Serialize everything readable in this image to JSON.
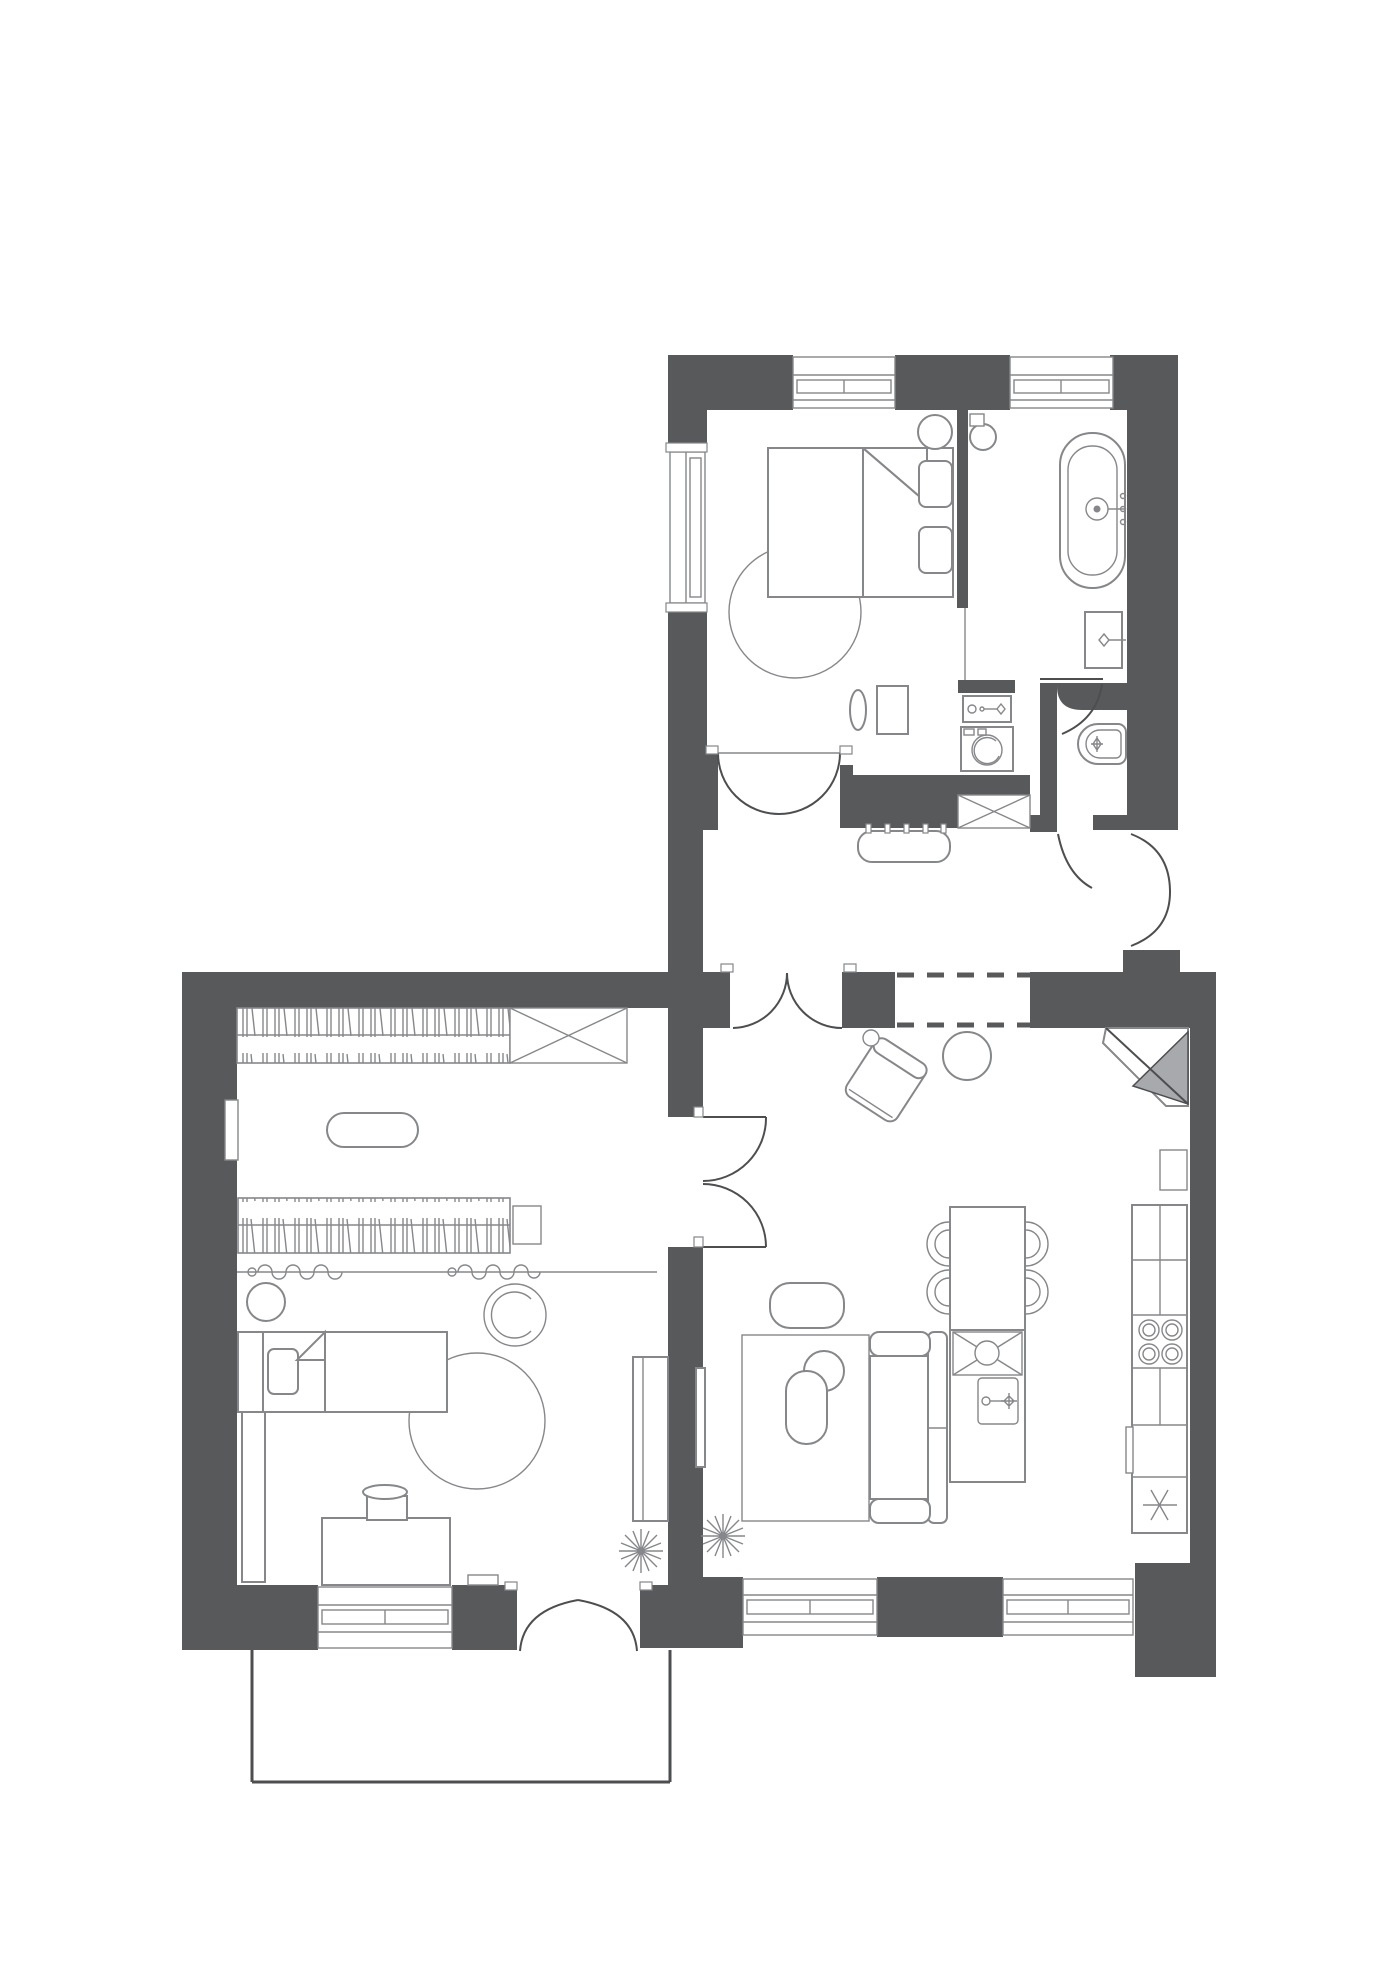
{
  "document": {
    "kind": "architectural-floor-plan",
    "view": "top-down",
    "style": "monochrome blueprint, dark gray walls, thin gray furniture linework, no text labels"
  },
  "palette": {
    "bg": "#ffffff",
    "wall": "#58595b",
    "line": "#85878a",
    "line-dark": "#4d4e50",
    "accent-gray": "#a7a9ac"
  },
  "rooms": [
    {
      "name": "bedroom",
      "items": [
        "double-bed",
        "blanket-fold",
        "pillows",
        "round-rug",
        "bedside-stool",
        "wall-window-left",
        "top-windows",
        "dressing-table",
        "vanity-stool",
        "double-swing-door"
      ]
    },
    {
      "name": "bathroom",
      "items": [
        "freestanding-bathtub",
        "tub-faucet",
        "washbasin-vanity",
        "vanity-faucet",
        "round-stool",
        "wall-control-box",
        "glass-screen",
        "swing-door"
      ]
    },
    {
      "name": "laundry-nook",
      "items": [
        "laundry-sink",
        "sink-faucet",
        "washing-machine"
      ]
    },
    {
      "name": "water-closet",
      "items": [
        "toilet-bidet",
        "swing-door"
      ]
    },
    {
      "name": "hallway",
      "items": [
        "bench-with-legs",
        "ventilation-shaft-x",
        "entry-double-door",
        "cased-opening-dashed",
        "double-swing-door-to-living"
      ]
    },
    {
      "name": "kids-room",
      "items": [
        "wardrobe-with-hangers-top",
        "built-in-closet-x",
        "wardrobe-with-hangers-mid",
        "storage-box",
        "ottoman-pouf",
        "curtain-rail-wavy",
        "floor-stool",
        "hanging-chair",
        "single-bed",
        "pillow",
        "blanket-fold",
        "round-rug",
        "side-counter",
        "piano",
        "piano-stool",
        "wall-shelf",
        "side-cabinet",
        "wall-niche",
        "plant",
        "double-door-to-living",
        "entry-double-door-bottom"
      ]
    },
    {
      "name": "living-kitchen",
      "items": [
        "lounge-chair-rotated",
        "ball-cushion",
        "round-side-table",
        "corner-fireplace",
        "ottoman",
        "area-rug",
        "round-coffee-table",
        "oval-coffee-table",
        "sofa",
        "tv-panel",
        "dining-table",
        "dining-chairs-4",
        "kitchen-island",
        "island-sink-x",
        "island-faucet-unit",
        "tall-kitchen-counter",
        "hob-4-burners",
        "oven-handle",
        "fridge-snowflake",
        "upper-cabinet",
        "bottom-windows",
        "plant-left",
        "plant-right"
      ]
    },
    {
      "name": "entry-porch",
      "items": [
        "platform-outline"
      ]
    }
  ]
}
